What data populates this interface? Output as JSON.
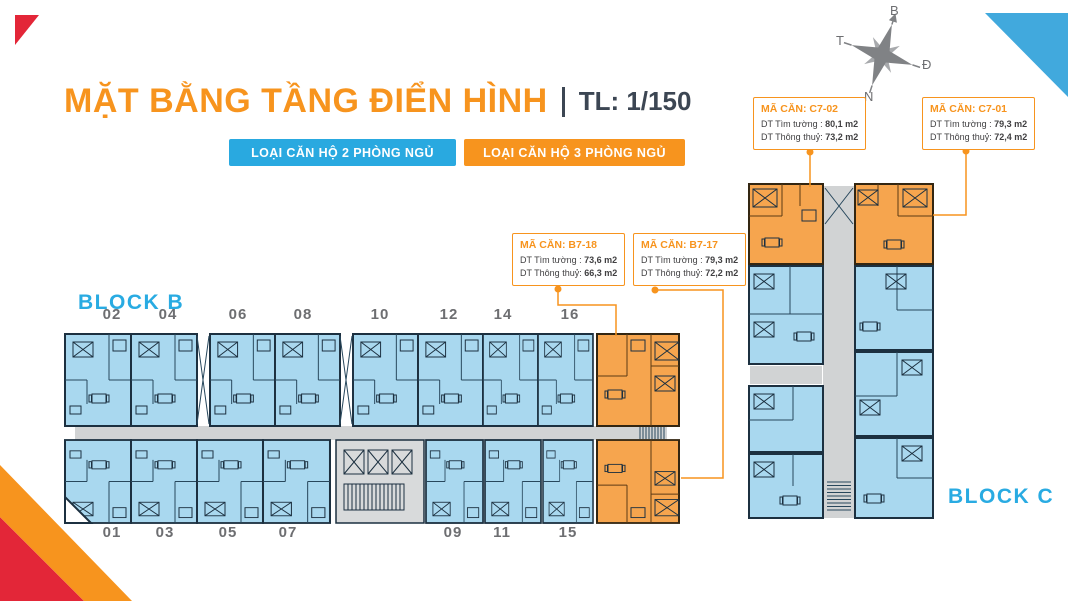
{
  "header": {
    "title": "MẶT BẰNG TẦNG ĐIỂN HÌNH",
    "scale": "TL: 1/150"
  },
  "legend": {
    "two_bedroom": {
      "label": "LOẠI CĂN HỘ 2 PHÒNG NGỦ",
      "color": "#29A9E0"
    },
    "three_bedroom": {
      "label": "LOẠI CĂN HỘ 3 PHÒNG NGỦ",
      "color": "#F7941E"
    }
  },
  "compass": {
    "north": "B",
    "south": "N",
    "east": "Đ",
    "west": "T"
  },
  "unit_cards": [
    {
      "id": "B7-18",
      "code": "MÃ CĂN: B7-18",
      "gross_label": "DT Tìm tường :",
      "gross_value": "73,6 m2",
      "net_label": "DT Thông thuỷ:",
      "net_value": "66,3 m2"
    },
    {
      "id": "B7-17",
      "code": "MÃ CĂN: B7-17",
      "gross_label": "DT Tìm tường :",
      "gross_value": "79,3 m2",
      "net_label": "DT Thông thuỷ:",
      "net_value": "72,2 m2"
    },
    {
      "id": "C7-02",
      "code": "MÃ CĂN: C7-02",
      "gross_label": "DT Tìm tường :",
      "gross_value": "80,1 m2",
      "net_label": "DT Thông thuỷ:",
      "net_value": "73,2 m2"
    },
    {
      "id": "C7-01",
      "code": "MÃ CĂN: C7-01",
      "gross_label": "DT Tìm tường :",
      "gross_value": "79,3 m2",
      "net_label": "DT Thông thuỷ:",
      "net_value": "72,4 m2"
    }
  ],
  "block_b": {
    "label": "BLOCK B",
    "top_unit_numbers": [
      "02",
      "04",
      "06",
      "08",
      "10",
      "12",
      "14",
      "16"
    ],
    "bottom_unit_numbers": [
      "01",
      "03",
      "05",
      "07",
      "09",
      "11",
      "15"
    ]
  },
  "block_c": {
    "label": "BLOCK C"
  },
  "colors": {
    "accent_orange": "#F7941E",
    "accent_blue": "#29A9E0",
    "plan_blue_fill": "#A9D8EF",
    "plan_orange_fill": "#F6A54E",
    "plan_wall": "#1C3040",
    "corridor_gray": "#D1D3D4",
    "corner_red": "#E32638",
    "corner_blue": "#41A9DD",
    "number_gray": "#6D6E71",
    "card_text": "#414042",
    "scale_text": "#3C4653"
  }
}
